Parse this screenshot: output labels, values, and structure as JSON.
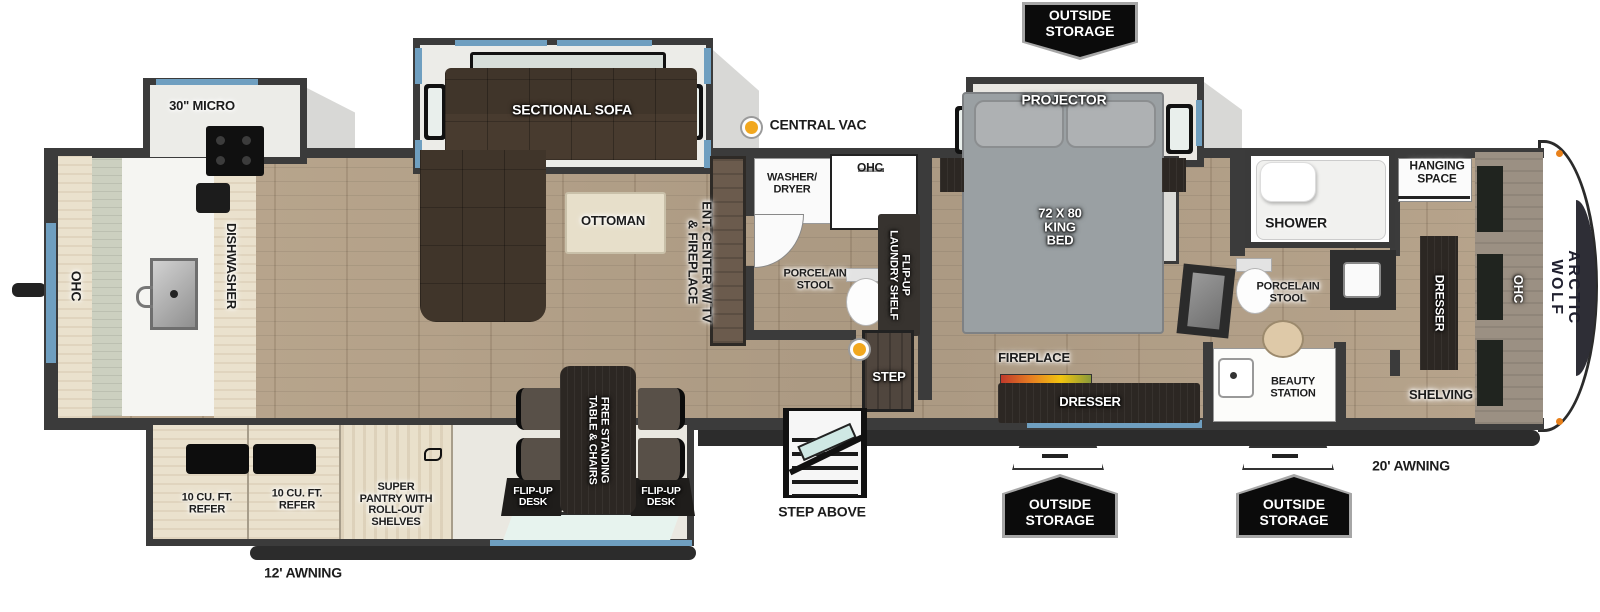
{
  "brand": "ARCTIC WOLF",
  "exterior": {
    "outside_storage": "OUTSIDE\nSTORAGE",
    "awning_front": "20' AWNING",
    "awning_rear": "12' AWNING",
    "step_above": "STEP ABOVE",
    "central_vac": "CENTRAL VAC"
  },
  "kitchen": {
    "micro": "30\" MICRO",
    "ohc": "OHC",
    "dishwasher": "DISHWASHER",
    "refer": "10 CU. FT.\nREFER",
    "super_pantry": "SUPER\nPANTRY WITH\nROLL-OUT\nSHELVES"
  },
  "living": {
    "sectional_sofa": "SECTIONAL SOFA",
    "ottoman": "OTTOMAN",
    "ent_center": "ENT. CENTER W/ TV\n& FIREPLACE",
    "table_chairs": "FREE STANDING\nTABLE & CHAIRS",
    "flip_up_desk": "FLIP-UP\nDESK"
  },
  "mid_bath": {
    "washer_dryer": "WASHER/\nDRYER",
    "ohc": "OHC",
    "porcelain_stool": "PORCELAIN\nSTOOL",
    "laundry_shelf": "FLIP-UP\nLAUNDRY SHELF",
    "step": "STEP"
  },
  "bedroom": {
    "projector": "PROJECTOR",
    "king_bed": "72 X 80\nKING\nBED",
    "fireplace": "FIREPLACE",
    "dresser": "DRESSER"
  },
  "front_bath": {
    "shower": "SHOWER",
    "porcelain_stool": "PORCELAIN\nSTOOL",
    "beauty_station": "BEAUTY\nSTATION"
  },
  "closet": {
    "hanging_space": "HANGING\nSPACE",
    "dresser": "DRESSER",
    "ohc": "OHC",
    "shelving": "SHELVING"
  },
  "colors": {
    "wall": "#3b3b3b",
    "floor_wood": "#b29f88",
    "cabinet": "#eae1cd",
    "dark_furniture": "#2c2723",
    "accent_blue": "#6f9fc0",
    "badge_bg": "#0b0b0b",
    "vac_dot": "#f1a71e",
    "bed_gray": "#9aa0a3"
  }
}
